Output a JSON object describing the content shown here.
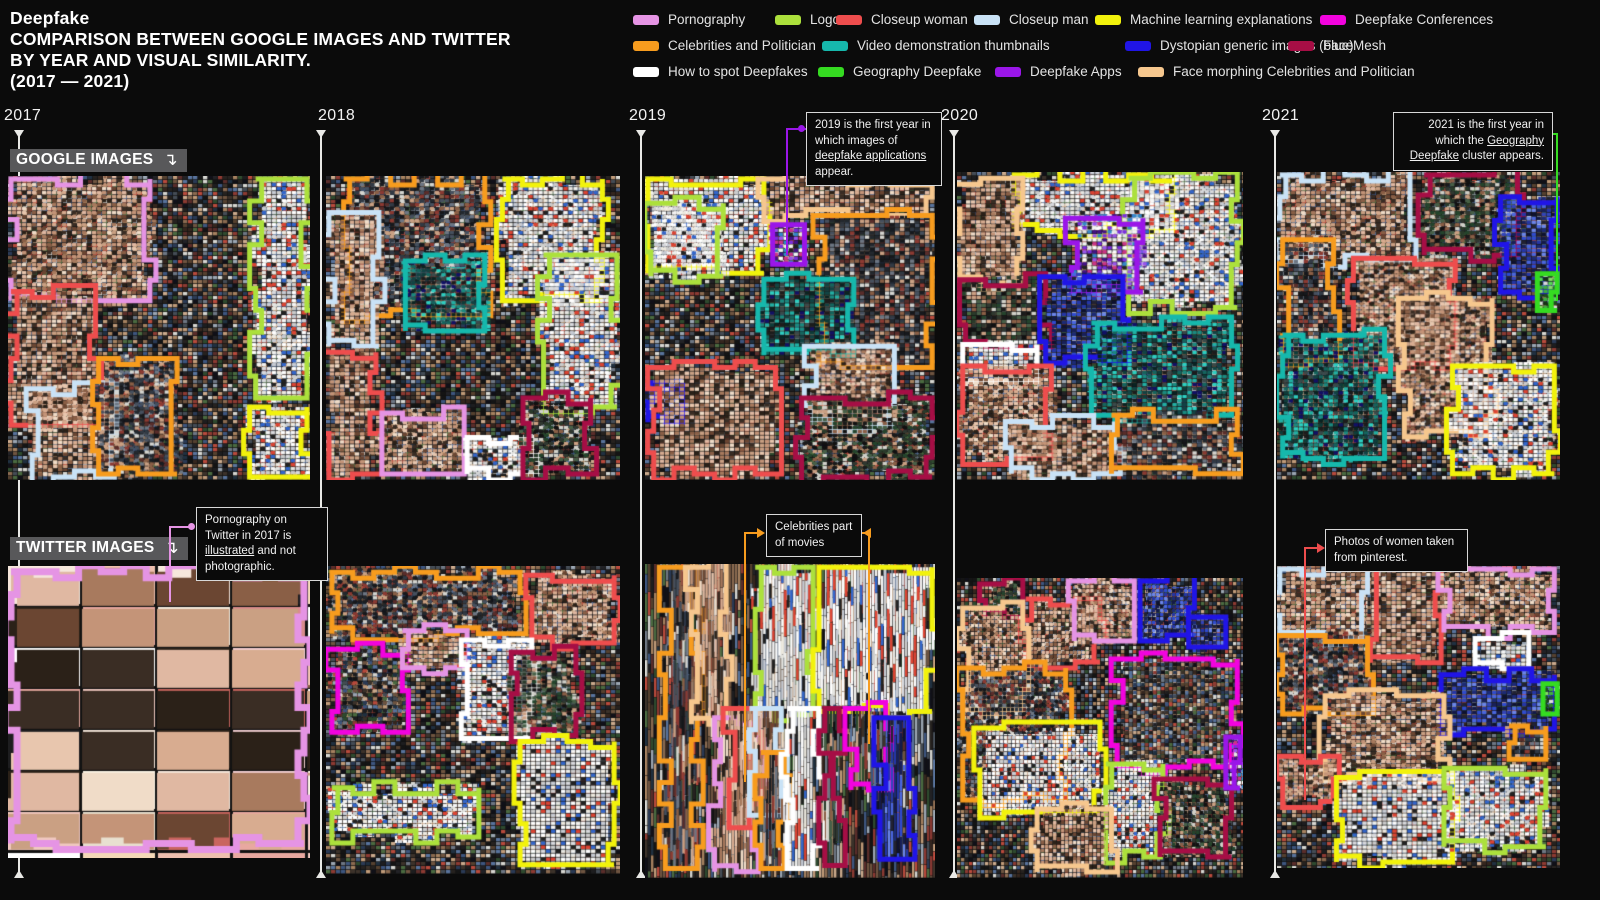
{
  "title": {
    "line1": "Deepfake",
    "line2": "COMPARISON BETWEEN GOOGLE IMAGES AND TWITTER",
    "line3": "BY YEAR AND VISUAL SIMILARITY.",
    "line4": "(2017 — 2021)"
  },
  "row_labels": {
    "google": "GOOGLE IMAGES",
    "twitter": "TWITTER IMAGES",
    "arrow_icon": "↴"
  },
  "years": [
    "2017",
    "2018",
    "2019",
    "2020",
    "2021"
  ],
  "legend": {
    "items": {
      "pornography": {
        "label": "Pornography",
        "color": "#E594E4"
      },
      "logos": {
        "label": "Logos",
        "color": "#ACE03C"
      },
      "closeup_woman": {
        "label": "Closeup woman",
        "color": "#EE4D4D"
      },
      "closeup_man": {
        "label": "Closeup man",
        "color": "#C9E2F6"
      },
      "ml_explanations": {
        "label": "Machine learning explanations",
        "color": "#F2F20C"
      },
      "conferences": {
        "label": "Deepfake Conferences",
        "color": "#F203DE"
      },
      "celebrities": {
        "label": "Celebrities and Politician",
        "color": "#F79C1E"
      },
      "video_demos": {
        "label": "Video demonstration thumbnails",
        "color": "#16B8AC"
      },
      "dystopian": {
        "label": "Dystopian generic images (blue)",
        "color": "#2015E6"
      },
      "facemesh": {
        "label": "FaceMesh",
        "color": "#A60E45"
      },
      "howto": {
        "label": "How to spot Deepfakes",
        "color": "#FFFFFF"
      },
      "geography": {
        "label": "Geography Deepfake",
        "color": "#35DB21"
      },
      "apps": {
        "label": "Deepfake Apps",
        "color": "#9A16E8"
      },
      "face_morphing": {
        "label": "Face morphing Celebrities and Politician",
        "color": "#F6C78E"
      }
    }
  },
  "callouts": [
    {
      "id": "co-apps",
      "cluster": "apps",
      "segments": [
        {
          "t": "2019 is the first year in which images of ",
          "u": false
        },
        {
          "t": "deepfake applications",
          "u": true
        },
        {
          "t": " appear.",
          "u": false
        }
      ]
    },
    {
      "id": "co-geo",
      "cluster": "geography",
      "segments": [
        {
          "t": "2021 is the first year in which the ",
          "u": false
        },
        {
          "t": "Geography Deepfake",
          "u": true
        },
        {
          "t": " cluster appears.",
          "u": false
        }
      ]
    },
    {
      "id": "co-porn",
      "cluster": "pornography",
      "segments": [
        {
          "t": "Pornography on Twitter in 2017 is ",
          "u": false
        },
        {
          "t": "illustrated",
          "u": true
        },
        {
          "t": " and not photographic.",
          "u": false
        }
      ]
    },
    {
      "id": "co-movies",
      "cluster": "celebrities",
      "segments": [
        {
          "t": "Celebrities part of movies",
          "u": false
        }
      ]
    },
    {
      "id": "co-pin",
      "cluster": "closeup_woman",
      "segments": [
        {
          "t": "Photos of women taken from pinterest.",
          "u": false
        }
      ]
    }
  ],
  "mosaics": [
    {
      "id": "google-2017",
      "year": "2017",
      "platform": "google",
      "style": "photo",
      "clusters": [
        {
          "c": "pornography",
          "x": 1,
          "y": 1,
          "w": 46,
          "h": 40
        },
        {
          "c": "closeup_woman",
          "x": 1,
          "y": 38,
          "w": 28,
          "h": 44
        },
        {
          "c": "closeup_man",
          "x": 8,
          "y": 70,
          "w": 28,
          "h": 29
        },
        {
          "c": "celebrities",
          "x": 30,
          "y": 60,
          "w": 26,
          "h": 38
        },
        {
          "c": "logos",
          "x": 82,
          "y": 1,
          "w": 17,
          "h": 72
        },
        {
          "c": "ml_explanations",
          "x": 80,
          "y": 76,
          "w": 19,
          "h": 23
        }
      ]
    },
    {
      "id": "google-2018",
      "year": "2018",
      "platform": "google",
      "style": "photo",
      "clusters": [
        {
          "c": "celebrities",
          "x": 6,
          "y": 1,
          "w": 48,
          "h": 45
        },
        {
          "c": "closeup_man",
          "x": 1,
          "y": 12,
          "w": 17,
          "h": 44
        },
        {
          "c": "video_demos",
          "x": 27,
          "y": 28,
          "w": 27,
          "h": 23
        },
        {
          "c": "ml_explanations",
          "x": 60,
          "y": 1,
          "w": 34,
          "h": 40
        },
        {
          "c": "logos",
          "x": 74,
          "y": 26,
          "w": 25,
          "h": 50
        },
        {
          "c": "closeup_woman",
          "x": 1,
          "y": 58,
          "w": 16,
          "h": 40
        },
        {
          "c": "pornography",
          "x": 19,
          "y": 78,
          "w": 28,
          "h": 20
        },
        {
          "c": "howto",
          "x": 48,
          "y": 86,
          "w": 22,
          "h": 12
        },
        {
          "c": "facemesh",
          "x": 67,
          "y": 73,
          "w": 23,
          "h": 25
        }
      ]
    },
    {
      "id": "google-2019",
      "year": "2019",
      "platform": "google",
      "style": "photo",
      "clusters": [
        {
          "c": "ml_explanations",
          "x": 1,
          "y": 1,
          "w": 40,
          "h": 31
        },
        {
          "c": "logos",
          "x": 2,
          "y": 9,
          "w": 25,
          "h": 24
        },
        {
          "c": "face_morphing",
          "x": 41,
          "y": 1,
          "w": 58,
          "h": 12
        },
        {
          "c": "apps",
          "x": 44,
          "y": 16,
          "w": 11,
          "h": 13
        },
        {
          "c": "celebrities",
          "x": 60,
          "y": 13,
          "w": 39,
          "h": 50
        },
        {
          "c": "video_demos",
          "x": 41,
          "y": 34,
          "w": 31,
          "h": 25
        },
        {
          "c": "closeup_man",
          "x": 57,
          "y": 56,
          "w": 29,
          "h": 26
        },
        {
          "c": "dystopian",
          "x": 1,
          "y": 68,
          "w": 12,
          "h": 13
        },
        {
          "c": "closeup_woman",
          "x": 3,
          "y": 63,
          "w": 42,
          "h": 35
        },
        {
          "c": "facemesh",
          "x": 54,
          "y": 73,
          "w": 45,
          "h": 26
        }
      ]
    },
    {
      "id": "google-2020",
      "year": "2020",
      "platform": "google",
      "style": "photo",
      "clusters": [
        {
          "c": "ml_explanations",
          "x": 20,
          "y": 1,
          "w": 56,
          "h": 18
        },
        {
          "c": "logos",
          "x": 60,
          "y": 2,
          "w": 38,
          "h": 42
        },
        {
          "c": "face_morphing",
          "x": 1,
          "y": 4,
          "w": 22,
          "h": 32
        },
        {
          "c": "apps",
          "x": 40,
          "y": 15,
          "w": 25,
          "h": 24
        },
        {
          "c": "facemesh",
          "x": 3,
          "y": 35,
          "w": 28,
          "h": 22
        },
        {
          "c": "dystopian",
          "x": 31,
          "y": 34,
          "w": 27,
          "h": 28
        },
        {
          "c": "video_demos",
          "x": 47,
          "y": 49,
          "w": 49,
          "h": 30
        },
        {
          "c": "howto",
          "x": 2,
          "y": 56,
          "w": 26,
          "h": 12
        },
        {
          "c": "closeup_woman",
          "x": 2,
          "y": 63,
          "w": 31,
          "h": 30
        },
        {
          "c": "closeup_man",
          "x": 19,
          "y": 81,
          "w": 36,
          "h": 17
        },
        {
          "c": "celebrities",
          "x": 54,
          "y": 79,
          "w": 44,
          "h": 19
        }
      ]
    },
    {
      "id": "google-2021",
      "year": "2021",
      "platform": "google",
      "style": "photo",
      "clusters": [
        {
          "c": "closeup_man",
          "x": 1,
          "y": 1,
          "w": 46,
          "h": 28
        },
        {
          "c": "facemesh",
          "x": 52,
          "y": 1,
          "w": 33,
          "h": 26
        },
        {
          "c": "dystopian",
          "x": 79,
          "y": 8,
          "w": 20,
          "h": 31
        },
        {
          "c": "geography",
          "x": 92,
          "y": 33,
          "w": 7,
          "h": 12
        },
        {
          "c": "celebrities",
          "x": 2,
          "y": 22,
          "w": 18,
          "h": 39
        },
        {
          "c": "closeup_woman",
          "x": 27,
          "y": 28,
          "w": 36,
          "h": 36
        },
        {
          "c": "video_demos",
          "x": 2,
          "y": 53,
          "w": 36,
          "h": 40
        },
        {
          "c": "face_morphing",
          "x": 45,
          "y": 41,
          "w": 31,
          "h": 45
        },
        {
          "c": "ml_explanations",
          "x": 62,
          "y": 63,
          "w": 36,
          "h": 35
        }
      ]
    },
    {
      "id": "twitter-2017",
      "year": "2017",
      "platform": "twitter",
      "style": "cards",
      "clusters": [
        {
          "c": "pornography",
          "x": 1,
          "y": 2,
          "w": 97,
          "h": 93
        }
      ]
    },
    {
      "id": "twitter-2018",
      "year": "2018",
      "platform": "twitter",
      "style": "photo",
      "clusters": [
        {
          "c": "celebrities",
          "x": 2,
          "y": 2,
          "w": 64,
          "h": 20
        },
        {
          "c": "closeup_woman",
          "x": 70,
          "y": 3,
          "w": 28,
          "h": 22
        },
        {
          "c": "conferences",
          "x": 2,
          "y": 27,
          "w": 26,
          "h": 27
        },
        {
          "c": "pornography",
          "x": 26,
          "y": 21,
          "w": 22,
          "h": 12
        },
        {
          "c": "howto",
          "x": 46,
          "y": 24,
          "w": 24,
          "h": 32
        },
        {
          "c": "facemesh",
          "x": 63,
          "y": 28,
          "w": 22,
          "h": 27
        },
        {
          "c": "ml_explanations",
          "x": 66,
          "y": 57,
          "w": 32,
          "h": 40
        },
        {
          "c": "logos",
          "x": 2,
          "y": 72,
          "w": 50,
          "h": 16
        }
      ]
    },
    {
      "id": "twitter-2019",
      "year": "2019",
      "platform": "twitter",
      "style": "strips",
      "clusters": [
        {
          "c": "celebrities",
          "x": 7,
          "y": 1,
          "w": 11,
          "h": 96
        },
        {
          "c": "face_morphing",
          "x": 16,
          "y": 1,
          "w": 12,
          "h": 50
        },
        {
          "c": "logos",
          "x": 38,
          "y": 1,
          "w": 20,
          "h": 47
        },
        {
          "c": "ml_explanations",
          "x": 60,
          "y": 1,
          "w": 39,
          "h": 46
        },
        {
          "c": "pornography",
          "x": 24,
          "y": 49,
          "w": 15,
          "h": 49
        },
        {
          "c": "closeup_woman",
          "x": 29,
          "y": 46,
          "w": 9,
          "h": 38
        },
        {
          "c": "closeup_man",
          "x": 36,
          "y": 46,
          "w": 11,
          "h": 34
        },
        {
          "c": "celebrities",
          "x": 40,
          "y": 60,
          "w": 8,
          "h": 37
        },
        {
          "c": "howto",
          "x": 49,
          "y": 46,
          "w": 11,
          "h": 51
        },
        {
          "c": "facemesh",
          "x": 62,
          "y": 46,
          "w": 5,
          "h": 50
        },
        {
          "c": "conferences",
          "x": 71,
          "y": 46,
          "w": 12,
          "h": 26
        },
        {
          "c": "dystopian",
          "x": 81,
          "y": 49,
          "w": 10,
          "h": 45
        }
      ]
    },
    {
      "id": "twitter-2020",
      "year": "2020",
      "platform": "twitter",
      "style": "grain",
      "clusters": [
        {
          "c": "facemesh",
          "x": 10,
          "y": 2,
          "w": 13,
          "h": 11
        },
        {
          "c": "closeup_woman",
          "x": 24,
          "y": 7,
          "w": 26,
          "h": 21
        },
        {
          "c": "pornography",
          "x": 41,
          "y": 1,
          "w": 21,
          "h": 20
        },
        {
          "c": "dystopian",
          "x": 64,
          "y": 1,
          "w": 19,
          "h": 18
        },
        {
          "c": "dystopian",
          "x": 81,
          "y": 13,
          "w": 13,
          "h": 10
        },
        {
          "c": "face_morphing",
          "x": 2,
          "y": 10,
          "w": 21,
          "h": 34
        },
        {
          "c": "celebrities",
          "x": 2,
          "y": 30,
          "w": 36,
          "h": 44
        },
        {
          "c": "ml_explanations",
          "x": 8,
          "y": 50,
          "w": 42,
          "h": 28
        },
        {
          "c": "conferences",
          "x": 56,
          "y": 27,
          "w": 42,
          "h": 36
        },
        {
          "c": "logos",
          "x": 52,
          "y": 62,
          "w": 20,
          "h": 31
        },
        {
          "c": "facemesh",
          "x": 71,
          "y": 67,
          "w": 25,
          "h": 26
        },
        {
          "c": "face_morphing",
          "x": 28,
          "y": 77,
          "w": 26,
          "h": 21
        },
        {
          "c": "apps",
          "x": 94,
          "y": 53,
          "w": 5,
          "h": 17
        }
      ]
    },
    {
      "id": "twitter-2021",
      "year": "2021",
      "platform": "twitter",
      "style": "photo",
      "clusters": [
        {
          "c": "closeup_man",
          "x": 1,
          "y": 1,
          "w": 31,
          "h": 23
        },
        {
          "c": "closeup_woman",
          "x": 33,
          "y": 1,
          "w": 25,
          "h": 31
        },
        {
          "c": "pornography",
          "x": 59,
          "y": 1,
          "w": 39,
          "h": 21
        },
        {
          "c": "howto",
          "x": 70,
          "y": 24,
          "w": 19,
          "h": 10
        },
        {
          "c": "dystopian",
          "x": 58,
          "y": 36,
          "w": 40,
          "h": 18
        },
        {
          "c": "celebrities",
          "x": 2,
          "y": 23,
          "w": 30,
          "h": 26
        },
        {
          "c": "face_morphing",
          "x": 17,
          "y": 43,
          "w": 42,
          "h": 28
        },
        {
          "c": "closeup_woman",
          "x": 2,
          "y": 63,
          "w": 20,
          "h": 15
        },
        {
          "c": "ml_explanations",
          "x": 21,
          "y": 70,
          "w": 41,
          "h": 28
        },
        {
          "c": "logos",
          "x": 59,
          "y": 67,
          "w": 36,
          "h": 26
        },
        {
          "c": "geography",
          "x": 94,
          "y": 39,
          "w": 5,
          "h": 10
        },
        {
          "c": "celebrities",
          "x": 82,
          "y": 53,
          "w": 13,
          "h": 11
        }
      ]
    }
  ],
  "chart_data": {
    "type": "heatmap",
    "title": "Deepfake — comparison between Google Images and Twitter by year and visual similarity (2017 — 2021)",
    "x": [
      "2017",
      "2018",
      "2019",
      "2020",
      "2021"
    ],
    "rows": [
      "GOOGLE IMAGES",
      "TWITTER IMAGES"
    ],
    "categories": [
      "Pornography",
      "Logos",
      "Closeup woman",
      "Closeup man",
      "Machine learning explanations",
      "Deepfake Conferences",
      "Celebrities and Politician",
      "Video demonstration thumbnails",
      "Dystopian generic images (blue)",
      "FaceMesh",
      "How to spot Deepfakes",
      "Geography Deepfake",
      "Deepfake Apps",
      "Face morphing Celebrities and Politician"
    ],
    "notes": [
      "2019 is the first year in which images of deepfake applications appear.",
      "2021 is the first year in which the Geography Deepfake cluster appears.",
      "Pornography on Twitter in 2017 is illustrated and not photographic.",
      "Celebrities part of movies",
      "Photos of women taken from pinterest."
    ]
  }
}
